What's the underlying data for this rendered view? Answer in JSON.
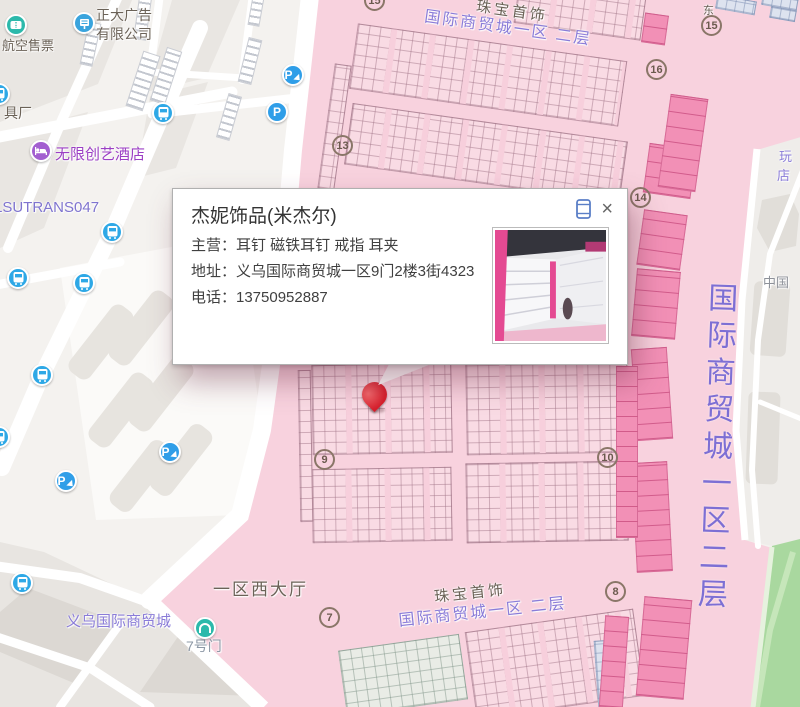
{
  "window": {
    "width": 800,
    "height": 707,
    "app": "web-map"
  },
  "popup": {
    "title": "杰妮饰品(米杰尔)",
    "business": "主营：耳钉 磁铁耳钉 戒指 耳夹",
    "address": "地址：义乌国际商贸城一区9门2楼3街4323",
    "phone": "电话：13750952887",
    "close_glyph": "×"
  },
  "map": {
    "labels": {
      "air_ticket": "航空售票",
      "ad_company_l1": "正大广告",
      "ad_company_l2": "有限公司",
      "factory_partial": "具厂",
      "hotel": "无限创艺酒店",
      "route_code": "LSUTRANS047",
      "market_sw": "义乌国际商贸城",
      "gate7_door": "7号门",
      "west_hall": "一区西大厅",
      "jewelry_top": "珠宝首饰",
      "district_floor_top": "国际商贸城一区  二层",
      "jewelry_bottom": "珠宝首饰",
      "district_floor_bottom": "国际商贸城一区  二层",
      "district_right_vertical": "国际商贸城一区二层",
      "china_partial": "中国",
      "toy_partial_top": "玩",
      "toy_partial_bottom": "店",
      "east": "东"
    },
    "gates": [
      "15",
      "16",
      "13",
      "14",
      "15",
      "9",
      "10",
      "7",
      "8"
    ],
    "icons": {
      "parking_glyph": "P"
    }
  },
  "colors": {
    "market_pink": "#f8d2de",
    "stall_dark_pink": "#f290b6",
    "label_purple": "#8a7cd8",
    "right_text_purple": "#7d6fd4",
    "pin_red": "#d61f2c",
    "bus_blue": "#2ea8e6",
    "teal": "#2cb9ab",
    "hotel_purple": "#a35fd0",
    "green_area": "#a9d89f"
  }
}
